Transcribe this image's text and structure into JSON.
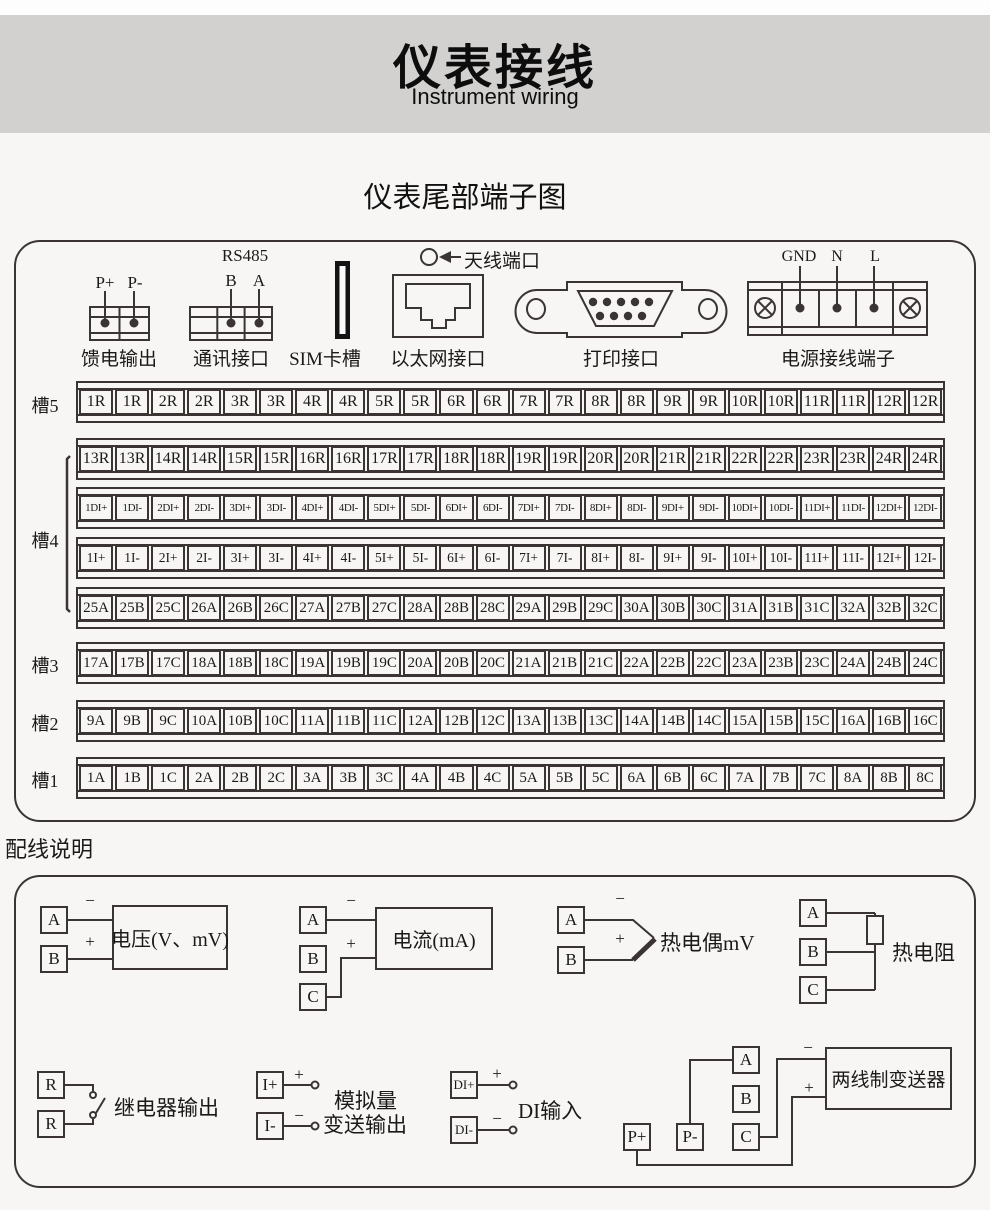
{
  "page": {
    "title": "仪表接线",
    "subtitle": "Instrument wiring"
  },
  "terminal_section": {
    "heading": "仪表尾部端子图",
    "connectors": {
      "feed": {
        "caption": "馈电输出",
        "pins": [
          "P+",
          "P-"
        ]
      },
      "comm": {
        "caption": "通讯接口",
        "bus": "RS485",
        "pins": [
          "B",
          "A"
        ]
      },
      "sim": {
        "caption": "SIM卡槽"
      },
      "ethernet": {
        "caption": "以太网接口"
      },
      "antenna": {
        "caption": "天线端口"
      },
      "printer": {
        "caption": "打印接口"
      },
      "power": {
        "caption": "电源接线端子",
        "pins": [
          "GND",
          "N",
          "L"
        ]
      }
    },
    "slot_labels": [
      "槽5",
      "槽4",
      "槽3",
      "槽2",
      "槽1"
    ],
    "rows": [
      {
        "cells": [
          "1R",
          "1R",
          "2R",
          "2R",
          "3R",
          "3R",
          "4R",
          "4R",
          "5R",
          "5R",
          "6R",
          "6R",
          "7R",
          "7R",
          "8R",
          "8R",
          "9R",
          "9R",
          "10R",
          "10R",
          "11R",
          "11R",
          "12R",
          "12R"
        ]
      },
      {
        "cells": [
          "13R",
          "13R",
          "14R",
          "14R",
          "15R",
          "15R",
          "16R",
          "16R",
          "17R",
          "17R",
          "18R",
          "18R",
          "19R",
          "19R",
          "20R",
          "20R",
          "21R",
          "21R",
          "22R",
          "22R",
          "23R",
          "23R",
          "24R",
          "24R"
        ]
      },
      {
        "cells": [
          "1DI+",
          "1DI-",
          "2DI+",
          "2DI-",
          "3DI+",
          "3DI-",
          "4DI+",
          "4DI-",
          "5DI+",
          "5DI-",
          "6DI+",
          "6DI-",
          "7DI+",
          "7DI-",
          "8DI+",
          "8DI-",
          "9DI+",
          "9DI-",
          "10DI+",
          "10DI-",
          "11DI+",
          "11DI-",
          "12DI+",
          "12DI-"
        ]
      },
      {
        "cells": [
          "1I+",
          "1I-",
          "2I+",
          "2I-",
          "3I+",
          "3I-",
          "4I+",
          "4I-",
          "5I+",
          "5I-",
          "6I+",
          "6I-",
          "7I+",
          "7I-",
          "8I+",
          "8I-",
          "9I+",
          "9I-",
          "10I+",
          "10I-",
          "11I+",
          "11I-",
          "12I+",
          "12I-"
        ]
      },
      {
        "cells": [
          "25A",
          "25B",
          "25C",
          "26A",
          "26B",
          "26C",
          "27A",
          "27B",
          "27C",
          "28A",
          "28B",
          "28C",
          "29A",
          "29B",
          "29C",
          "30A",
          "30B",
          "30C",
          "31A",
          "31B",
          "31C",
          "32A",
          "32B",
          "32C"
        ]
      },
      {
        "cells": [
          "17A",
          "17B",
          "17C",
          "18A",
          "18B",
          "18C",
          "19A",
          "19B",
          "19C",
          "20A",
          "20B",
          "20C",
          "21A",
          "21B",
          "21C",
          "22A",
          "22B",
          "22C",
          "23A",
          "23B",
          "23C",
          "24A",
          "24B",
          "24C"
        ]
      },
      {
        "cells": [
          "9A",
          "9B",
          "9C",
          "10A",
          "10B",
          "10C",
          "11A",
          "11B",
          "11C",
          "12A",
          "12B",
          "12C",
          "13A",
          "13B",
          "13C",
          "14A",
          "14B",
          "14C",
          "15A",
          "15B",
          "15C",
          "16A",
          "16B",
          "16C"
        ]
      },
      {
        "cells": [
          "1A",
          "1B",
          "1C",
          "2A",
          "2B",
          "2C",
          "3A",
          "3B",
          "3C",
          "4A",
          "4B",
          "4C",
          "5A",
          "5B",
          "5C",
          "6A",
          "6B",
          "6C",
          "7A",
          "7B",
          "7C",
          "8A",
          "8B",
          "8C"
        ]
      }
    ]
  },
  "wiring": {
    "heading": "配线说明",
    "sym": {
      "plus": "+",
      "minus": "−"
    },
    "diagrams": {
      "voltage": {
        "terminals": [
          "A",
          "B"
        ],
        "device": "电压(V、mV)"
      },
      "current": {
        "terminals": [
          "A",
          "B",
          "C"
        ],
        "device": "电流(mA)"
      },
      "thermocouple": {
        "terminals": [
          "A",
          "B"
        ],
        "label": "热电偶mV"
      },
      "rtd": {
        "terminals": [
          "A",
          "B",
          "C"
        ],
        "label": "热电阻"
      },
      "relay": {
        "terminals": [
          "R",
          "R"
        ],
        "label": "继电器输出"
      },
      "analog_out": {
        "terminals": [
          "I+",
          "I-"
        ],
        "label_line1": "模拟量",
        "label_line2": "变送输出"
      },
      "di": {
        "terminals": [
          "DI+",
          "DI-"
        ],
        "label": "DI输入"
      },
      "transmitter": {
        "terminals": [
          "A",
          "B",
          "C",
          "P+",
          "P-"
        ],
        "device": "两线制变送器"
      }
    }
  }
}
